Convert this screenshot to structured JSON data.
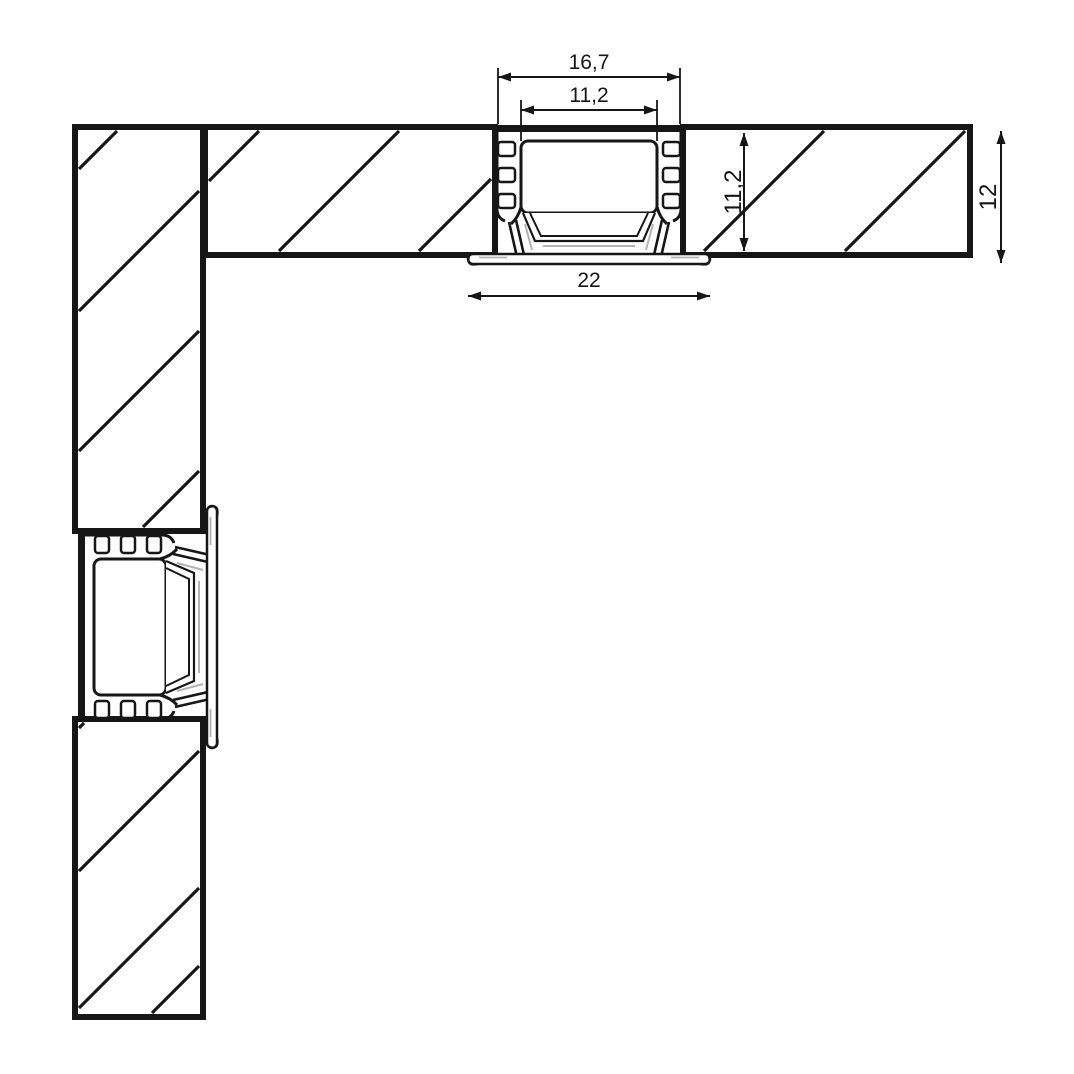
{
  "drawing": {
    "background": "#ffffff",
    "line_color": "#161616",
    "accent_gray": "#b3b3b3",
    "canvas_width": 1074,
    "canvas_height": 1074
  },
  "dimensions": [
    {
      "id": "outer-width",
      "label": "16,7",
      "orientation": "horizontal",
      "x1": 498,
      "x2": 680,
      "y": 77,
      "label_x": 589,
      "label_y": 69,
      "ext_lines": [
        [
          498,
          68,
          124
        ],
        [
          680,
          68,
          124
        ]
      ]
    },
    {
      "id": "inner-width",
      "label": "11,2",
      "orientation": "horizontal",
      "x1": 521,
      "x2": 657,
      "y": 110,
      "label_x": 589,
      "label_y": 102,
      "ext_lines": [
        [
          521,
          100,
          141
        ],
        [
          657,
          100,
          141
        ]
      ]
    },
    {
      "id": "overall-width",
      "label": "22",
      "orientation": "horizontal",
      "x1": 468,
      "x2": 710,
      "y": 296,
      "label_x": 589,
      "label_y": 287,
      "ext_lines": []
    },
    {
      "id": "recess-depth",
      "label": "11,2",
      "orientation": "vertical",
      "x": 744,
      "y1": 133,
      "y2": 251,
      "label_x": 741,
      "label_y": 192,
      "ext_lines": []
    },
    {
      "id": "board-thickness",
      "label": "12",
      "orientation": "vertical",
      "x": 1001,
      "y1": 131,
      "y2": 263,
      "label_x": 996,
      "label_y": 197,
      "ext_lines": []
    }
  ],
  "boards": [
    {
      "id": "board-upper-left-vertical",
      "x": 75,
      "y": 127,
      "w": 128,
      "h": 404,
      "hatch": [
        248,
        390,
        530,
        670
      ]
    },
    {
      "id": "board-top-horizontal",
      "x": 205,
      "y": 127,
      "w": 290,
      "h": 128,
      "hatch": [
        248,
        390,
        530,
        670
      ]
    },
    {
      "id": "board-right-horizontal",
      "x": 683,
      "y": 127,
      "w": 287,
      "h": 128,
      "hatch": [
        955,
        1096
      ]
    },
    {
      "id": "board-lower-left-vertical",
      "x": 75,
      "y": 719,
      "w": 128,
      "h": 298,
      "hatch": [
        807,
        950,
        1087,
        1165
      ]
    }
  ],
  "profiles": [
    {
      "id": "led-profile-top",
      "transform": "translate(589,125)"
    },
    {
      "id": "led-profile-left",
      "transform": "translate(78,627) rotate(-90)"
    }
  ],
  "strokes": {
    "board": 6,
    "hatch": 3.2,
    "dim": 2,
    "ext": 1.8
  }
}
